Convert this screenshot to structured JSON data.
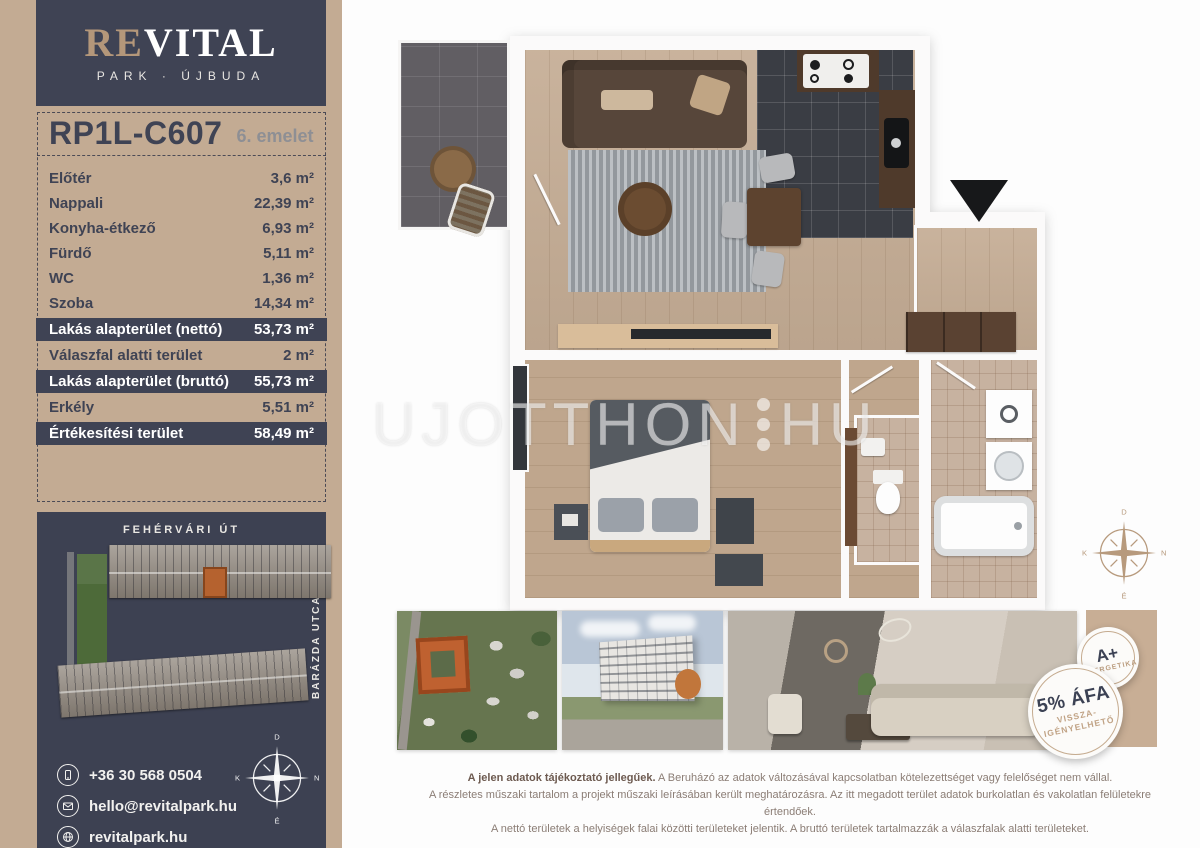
{
  "brand": {
    "re": "RE",
    "vital": "VITAL",
    "subtitle": "PARK · ÚJBUDA"
  },
  "unit": {
    "code": "RP1L-C607",
    "floor": "6. emelet"
  },
  "areas": {
    "rows": [
      {
        "label": "Előtér",
        "value": "3,6 m²",
        "highlight": false
      },
      {
        "label": "Nappali",
        "value": "22,39 m²",
        "highlight": false
      },
      {
        "label": "Konyha-étkező",
        "value": "6,93 m²",
        "highlight": false
      },
      {
        "label": "Fürdő",
        "value": "5,11 m²",
        "highlight": false
      },
      {
        "label": "WC",
        "value": "1,36 m²",
        "highlight": false
      },
      {
        "label": "Szoba",
        "value": "14,34 m²",
        "highlight": false
      },
      {
        "label": "Lakás alapterület (nettó)",
        "value": "53,73 m²",
        "highlight": true
      },
      {
        "label": "Válaszfal alatti terület",
        "value": "2 m²",
        "highlight": false
      },
      {
        "label": "Lakás alapterület (bruttó)",
        "value": "55,73 m²",
        "highlight": true
      },
      {
        "label": "Erkély",
        "value": "5,51 m²",
        "highlight": false
      },
      {
        "label": "Értékesítési terület",
        "value": "58,49 m²",
        "highlight": true
      }
    ]
  },
  "site": {
    "street_top": "FEHÉRVÁRI ÚT",
    "street_right": "BARÁZDA UTCA"
  },
  "contact": {
    "phone": "+36 30 568 0504",
    "email": "hello@revitalpark.hu",
    "web": "revitalpark.hu"
  },
  "compass": {
    "top": "D",
    "right": "NY",
    "bottom": "É",
    "left": "K"
  },
  "watermark": {
    "left": "UJOTTHON",
    "right": "HU"
  },
  "badges": {
    "energy_title": "A+",
    "energy_sub": "ENERGETIKA",
    "vat_title": "5% ÁFA",
    "vat_sub1": "VISSZA-",
    "vat_sub2": "IGÉNYELHETŐ"
  },
  "disclaimer": {
    "bold": "A jelen adatok tájékoztató jellegűek.",
    "line1": " A Beruházó az adatok változásával kapcsolatban kötelezettséget vagy felelőséget nem vállal.",
    "line2": "A részletes műszaki tartalom a projekt műszaki leírásában került meghatározásra. Az itt megadott terület adatok burkolatlan és vakolatlan felületekre értendőek.",
    "line3": "A nettó területek a helyiségek falai közötti területeket jelentik. A bruttó területek tartalmazzák a válaszfalak alatti területeket."
  },
  "colors": {
    "tan": "#c3ab93",
    "slate": "#3f4354",
    "orange": "#b5622f",
    "badge_tan": "#bb9d7f"
  }
}
